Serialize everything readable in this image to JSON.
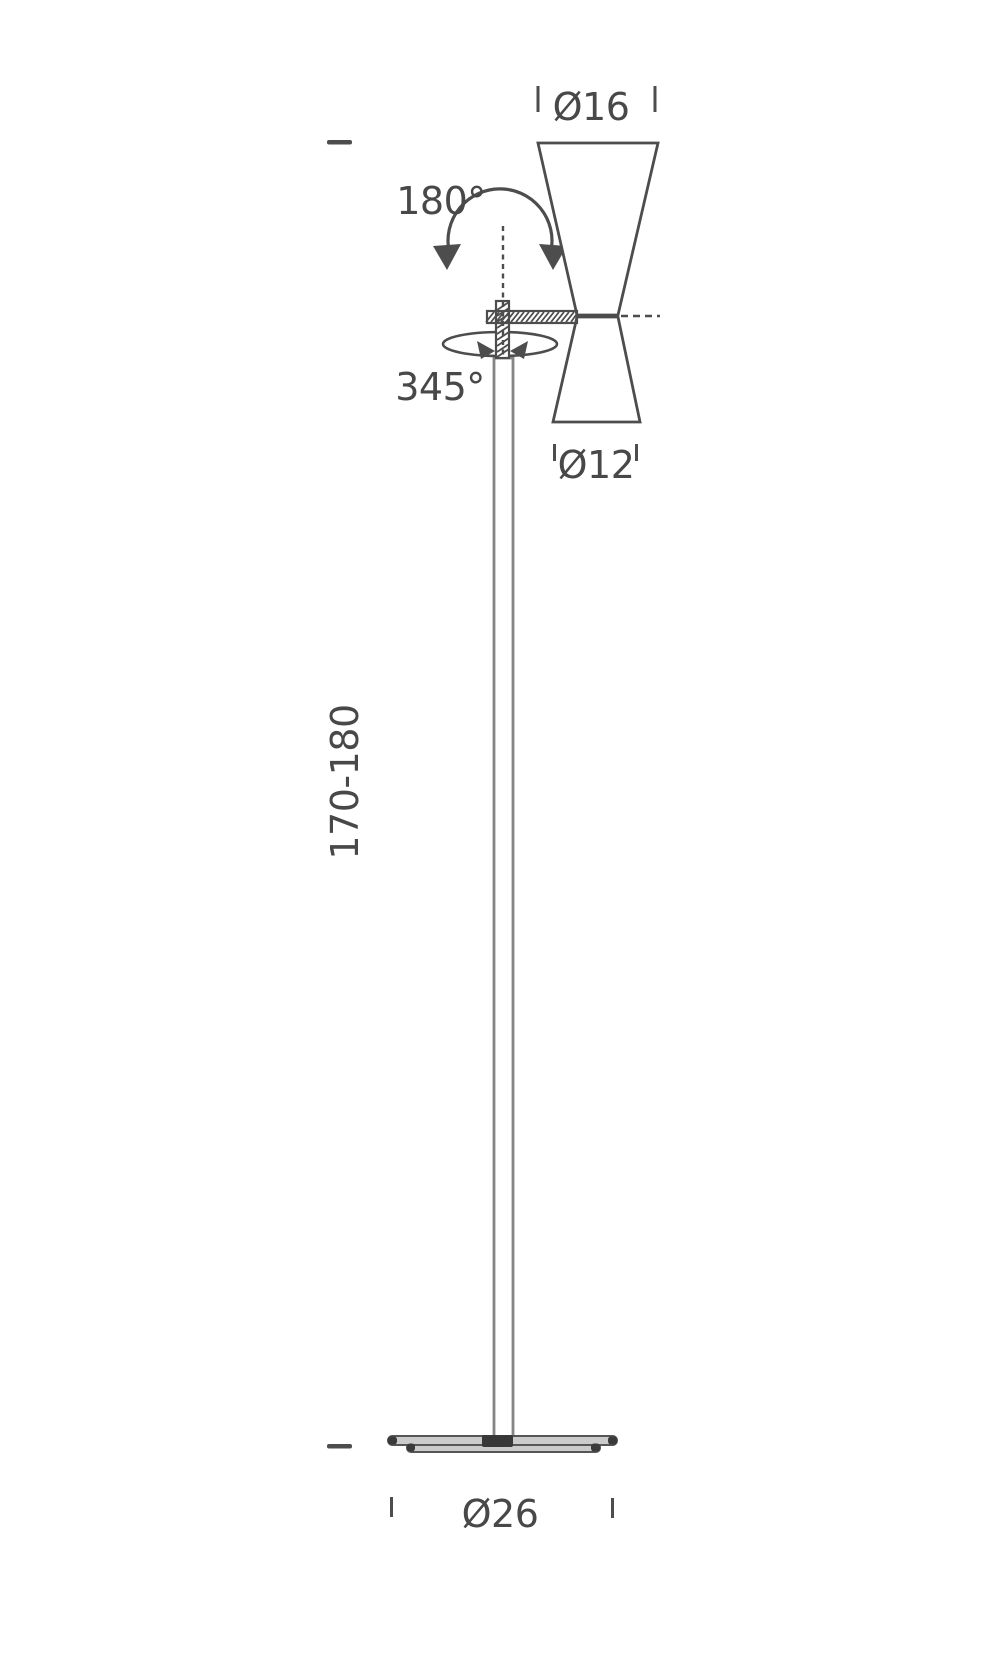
{
  "diagram": {
    "subject": "Floor lamp dimensional line drawing",
    "colors": {
      "background": "#ffffff",
      "line": "#4d4d4d",
      "pole_line": "#858585",
      "text": "#484848",
      "base_fill": "#cbcbcb",
      "base_dark": "#3a3a3a"
    },
    "labels": {
      "shade_top_diameter": "Ø16",
      "tilt_angle": "180°",
      "rotation_angle": "345°",
      "shade_bottom_diameter": "Ø12",
      "height_range": "170-180",
      "base_diameter": "Ø26"
    }
  }
}
